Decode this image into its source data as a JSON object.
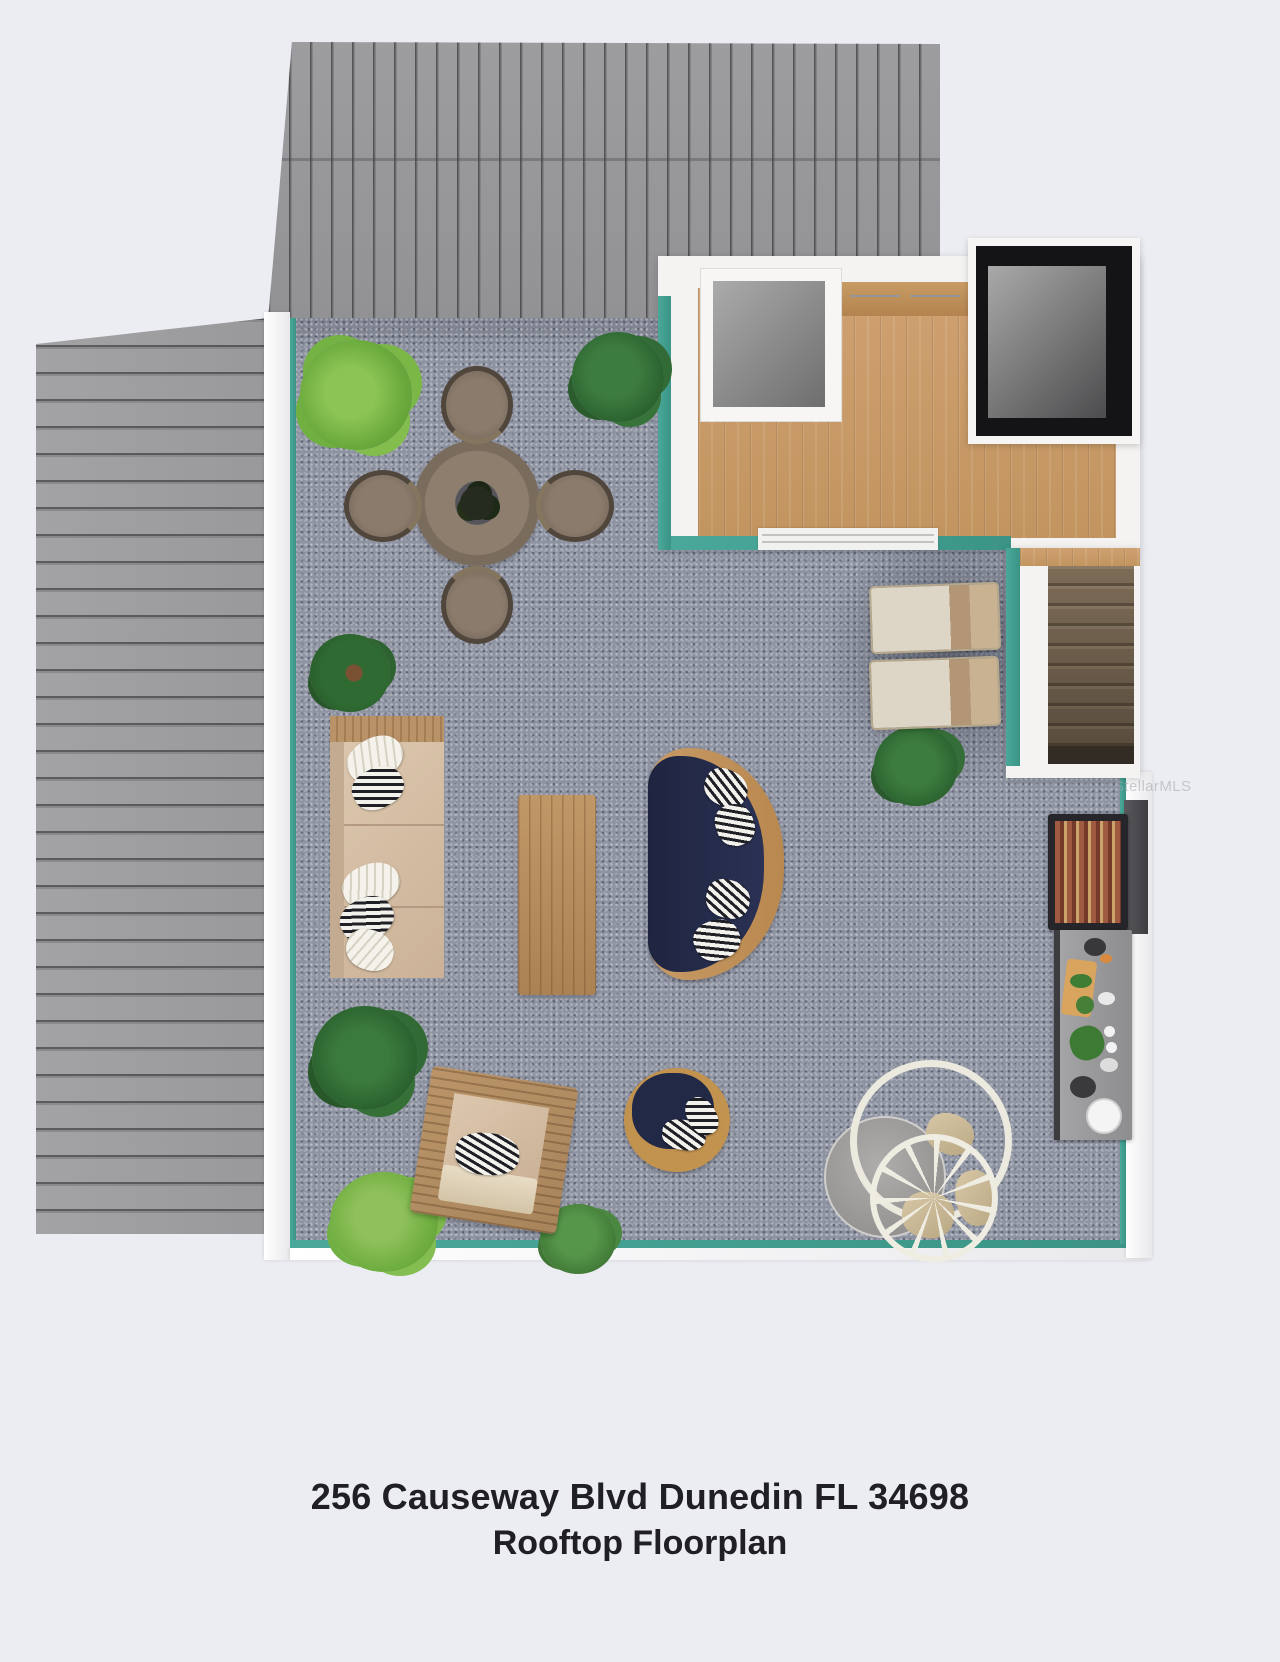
{
  "caption": {
    "line1": "256 Causeway Blvd Dunedin FL 34698",
    "line2": "Rooftop Floorplan"
  },
  "watermark": {
    "text": "StellarMLS"
  },
  "colors": {
    "background": "#ecedf2",
    "deck_surface": "#8e93a2",
    "parapet_teal": "#42a092",
    "parapet_white": "#f4f4f4",
    "roof_metal": "#9a9a9d",
    "wood_floor": "#c89a6a",
    "stair_wood": "#7c6b56",
    "navy_cushion": "#252c4e",
    "wicker": "#b98c5c",
    "caption_text": "#202024"
  },
  "objects": [
    "upper-gable-roof",
    "left-gable-roof",
    "rooftop-deck",
    "interior-landing-room",
    "closet",
    "kitchen-cabinets",
    "skylight-shaft",
    "staircase",
    "dining-table",
    "wicker-chair",
    "outdoor-sofa",
    "coffee-table",
    "curved-navy-sofa",
    "round-navy-chair",
    "wicker-armchair",
    "lounge-chair",
    "hanging-egg-chair",
    "grill",
    "prep-counter",
    "potted-plant"
  ]
}
